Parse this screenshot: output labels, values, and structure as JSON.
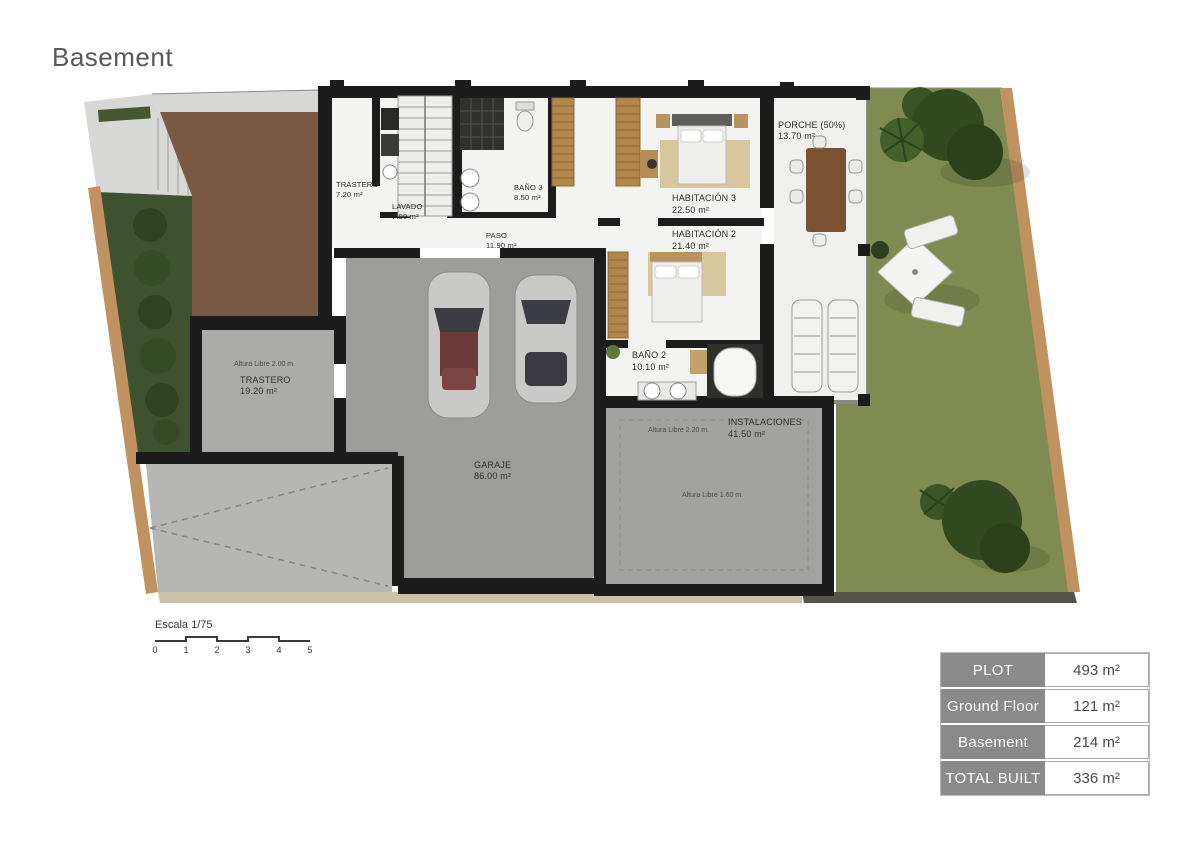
{
  "title": "Basement",
  "plan": {
    "rooms": {
      "trastero1": {
        "name": "TRASTERO",
        "area": "7.20 m²"
      },
      "lavado": {
        "name": "LAVADO",
        "area": "7.00 m²"
      },
      "bano3": {
        "name": "BAÑO 3",
        "area": "8.50 m²"
      },
      "paso": {
        "name": "PASO",
        "area": "11.90 m²"
      },
      "habitacion3": {
        "name": "HABITACIÓN 3",
        "area": "22.50 m²"
      },
      "porche": {
        "name": "PORCHE (50%)",
        "area": "13.70 m²"
      },
      "habitacion2": {
        "name": "HABITACIÓN 2",
        "area": "21.40 m²"
      },
      "bano2": {
        "name": "BAÑO 2",
        "area": "10.10 m²"
      },
      "trastero2": {
        "name": "TRASTERO",
        "area": "19.20 m²",
        "note": "Altura Libre 2.00 m."
      },
      "instalaciones": {
        "name": "INSTALACIONES",
        "area": "41.50 m²",
        "note": "Altura Libre 2.20 m."
      },
      "garaje": {
        "name": "GARAJE",
        "area": "86.00 m²",
        "note": "Altura Libre 1.60 m."
      }
    },
    "scale": {
      "label": "Escala 1/75",
      "ticks": [
        "0",
        "1",
        "2",
        "3",
        "4",
        "5"
      ]
    }
  },
  "summary_table": {
    "rows": [
      {
        "label": "PLOT",
        "value": "493 m²"
      },
      {
        "label": "Ground Floor",
        "value": "121 m²"
      },
      {
        "label": "Basement",
        "value": "214 m²"
      },
      {
        "label": "TOTAL BUILT",
        "value": "336 m²"
      }
    ]
  },
  "colors": {
    "wall": "#1c1c1c",
    "room_white": "#f3f3f1",
    "garage_floor": "#9d9d9b",
    "lawn_green": "#7f8b51",
    "terrace_brown": "#7a5a44",
    "pebble_tan": "#bf9260",
    "hedge_green": "#3f5230",
    "table_header_bg": "#8a8a8a"
  }
}
